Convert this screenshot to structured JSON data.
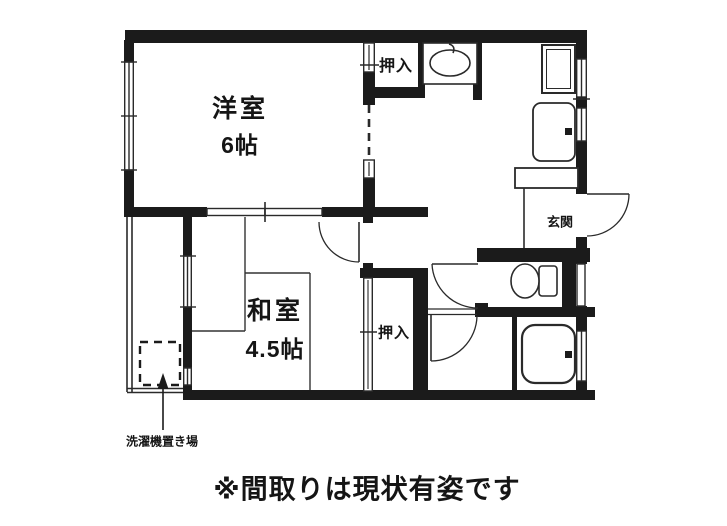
{
  "floorplan": {
    "western_room": {
      "name": "洋室",
      "size": "6帖"
    },
    "japanese_room": {
      "name": "和室",
      "size": "4.5帖"
    },
    "closet_top": {
      "label": "押入"
    },
    "closet_bottom": {
      "label": "押入"
    },
    "entrance": {
      "label": "玄関"
    },
    "laundry": {
      "label": "洗濯機置き場"
    },
    "footnote": "※間取りは現状有姿です",
    "colors": {
      "wall": "#1b1b1b",
      "line": "#2a2a2a",
      "background": "#ffffff"
    }
  }
}
